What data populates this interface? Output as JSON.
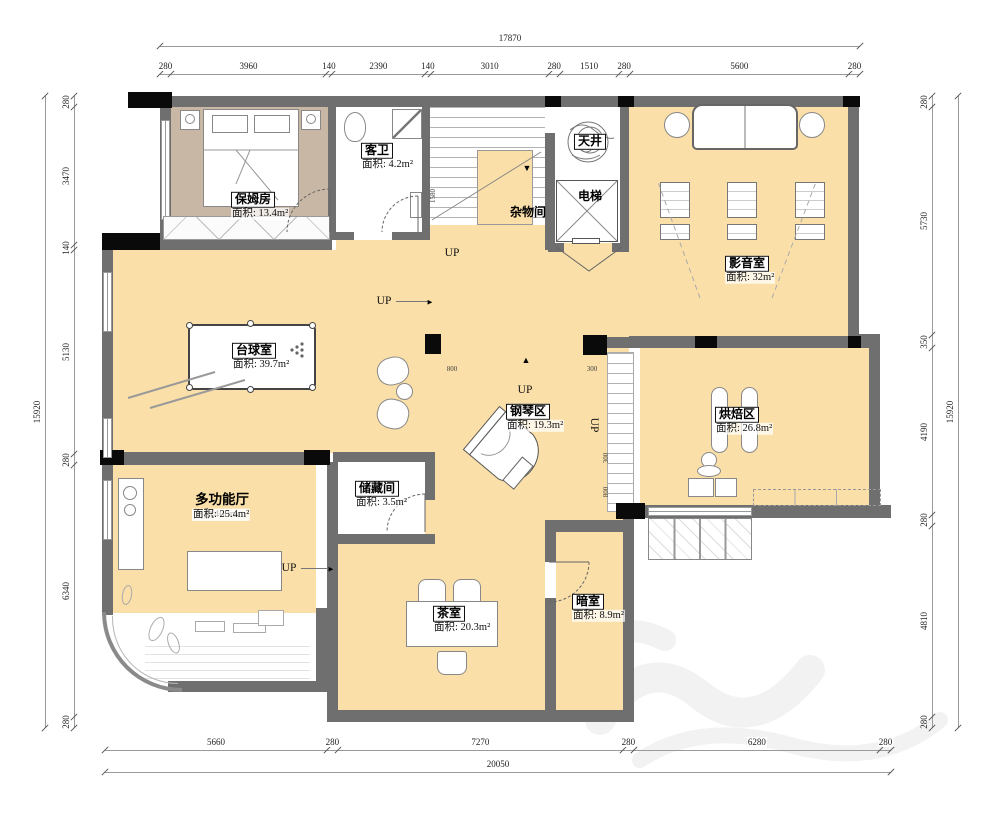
{
  "dimensions": {
    "top": {
      "total": "17870",
      "segments": [
        "280",
        "3960",
        "140",
        "2390",
        "140",
        "3010",
        "280",
        "1510",
        "280",
        "5600",
        "280"
      ]
    },
    "bottom": {
      "total": "20050",
      "segments": [
        "5660",
        "280",
        "7270",
        "280",
        "6280",
        "280"
      ]
    },
    "left": {
      "total": "15920",
      "segments": [
        "280",
        "3470",
        "140",
        "5130",
        "280",
        "6340",
        "280"
      ]
    },
    "right": {
      "total": "15920",
      "segments": [
        "280",
        "5730",
        "350",
        "4190",
        "280",
        "4810",
        "280"
      ]
    }
  },
  "rooms": [
    {
      "id": "nanny",
      "name": "保姆房",
      "area": "面积: 13.4m²",
      "x": 253,
      "y": 199
    },
    {
      "id": "guest-bath",
      "name": "客卫",
      "area": "面积: 4.2m²",
      "x": 377,
      "y": 150
    },
    {
      "id": "skylight",
      "name": "天井",
      "area": "",
      "x": 590,
      "y": 141
    },
    {
      "id": "elevator",
      "name": "电梯",
      "area": "",
      "x": 590,
      "y": 196,
      "plain": true
    },
    {
      "id": "utility",
      "name": "杂物间",
      "area": "",
      "x": 528,
      "y": 212,
      "plain": true
    },
    {
      "id": "media",
      "name": "影音室",
      "area": "面积: 32m²",
      "x": 747,
      "y": 263
    },
    {
      "id": "billiards",
      "name": "台球室",
      "area": "面积: 39.7m²",
      "x": 254,
      "y": 350
    },
    {
      "id": "piano",
      "name": "钢琴区",
      "area": "面积: 19.3m²",
      "x": 528,
      "y": 411
    },
    {
      "id": "baking",
      "name": "烘焙区",
      "area": "面积: 26.8m²",
      "x": 737,
      "y": 414
    },
    {
      "id": "multi",
      "name": "多功能厅",
      "sub": "下沉400mm",
      "area": "面积: 25.4m²",
      "x": 222,
      "y": 500,
      "bold": true
    },
    {
      "id": "storage",
      "name": "储藏间",
      "area": "面积: 3.5m²",
      "x": 377,
      "y": 488
    },
    {
      "id": "tea",
      "name": "茶室",
      "area": "面积: 20.3m²",
      "x": 449,
      "y": 613
    },
    {
      "id": "dark",
      "name": "暗室",
      "area": "面积: 8.9m²",
      "x": 588,
      "y": 601
    }
  ],
  "up_labels": [
    {
      "text": "UP",
      "x": 452,
      "y": 253
    },
    {
      "text": "UP",
      "x": 384,
      "y": 301,
      "arrow": true,
      "alen": 34
    },
    {
      "text": "UP",
      "x": 525,
      "y": 390
    },
    {
      "text": "UP",
      "x": 594,
      "y": 425,
      "rot": true
    },
    {
      "text": "UP",
      "x": 289,
      "y": 568,
      "arrow": true,
      "alen": 30
    }
  ],
  "small_dims": [
    {
      "text": "1580",
      "x": 433,
      "y": 196,
      "rot": true
    },
    {
      "text": "800",
      "x": 452,
      "y": 369
    },
    {
      "text": "300",
      "x": 592,
      "y": 369
    },
    {
      "text": "300",
      "x": 606,
      "y": 458,
      "rot": true
    },
    {
      "text": "800",
      "x": 606,
      "y": 492,
      "rot": true
    }
  ],
  "arrows": [
    {
      "glyph": "▼",
      "x": 527,
      "y": 168
    },
    {
      "glyph": "▲",
      "x": 526,
      "y": 360
    }
  ]
}
